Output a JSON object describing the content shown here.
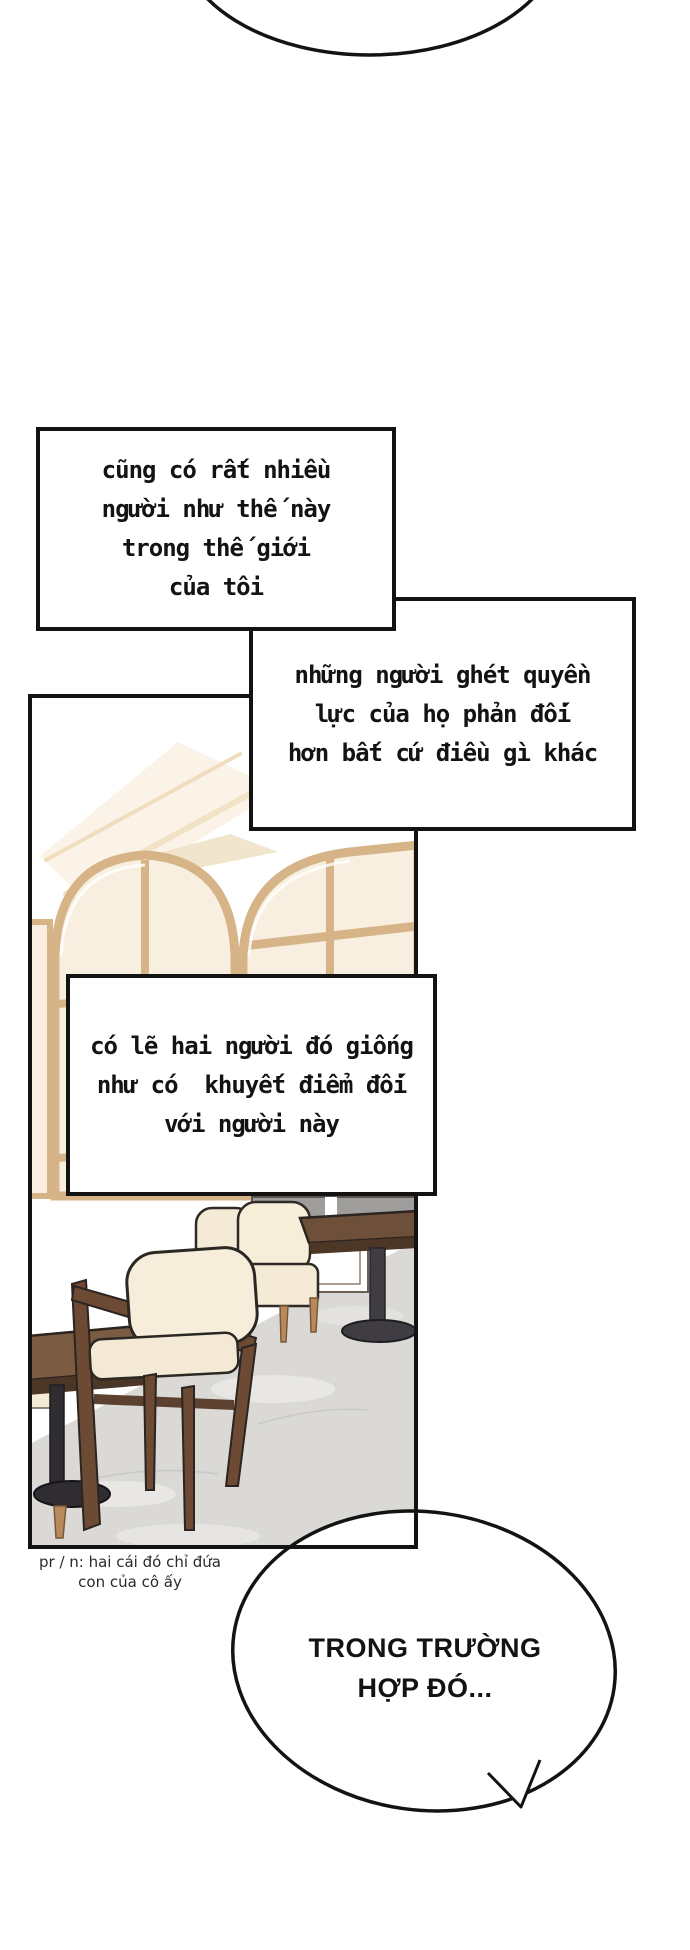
{
  "narration": {
    "box1": {
      "lines": [
        "cũng có rất nhiều",
        "người như thế này",
        "trong thế giới",
        "của tôi"
      ]
    },
    "box2": {
      "lines": [
        "những người ghét quyền",
        "lực của họ phản đối",
        "hơn bất cứ điều gì khác"
      ]
    },
    "box3": {
      "lines": [
        "có lẽ hai người đó giống",
        "như có  khuyết điểm đối",
        "với người này"
      ]
    }
  },
  "speech_bubble": {
    "line1": "TRONG TRƯỜNG",
    "line2": "HỢP ĐÓ..."
  },
  "translator_note": {
    "line1": "pr / n: hai cái đó chỉ đứa",
    "line2": "con của cô ấy"
  },
  "palette": {
    "ink": "#131313",
    "window_frame": "#d6b488",
    "glass": "#f8efe0",
    "glass_gray": "#9f9e9c",
    "wood": "#6e4f39",
    "wood_dark": "#4c3625",
    "walnut": "#6d4a33",
    "cushion": "#f5ecd9",
    "leg_tan": "#b9895e",
    "floor": "#dad9d6"
  }
}
